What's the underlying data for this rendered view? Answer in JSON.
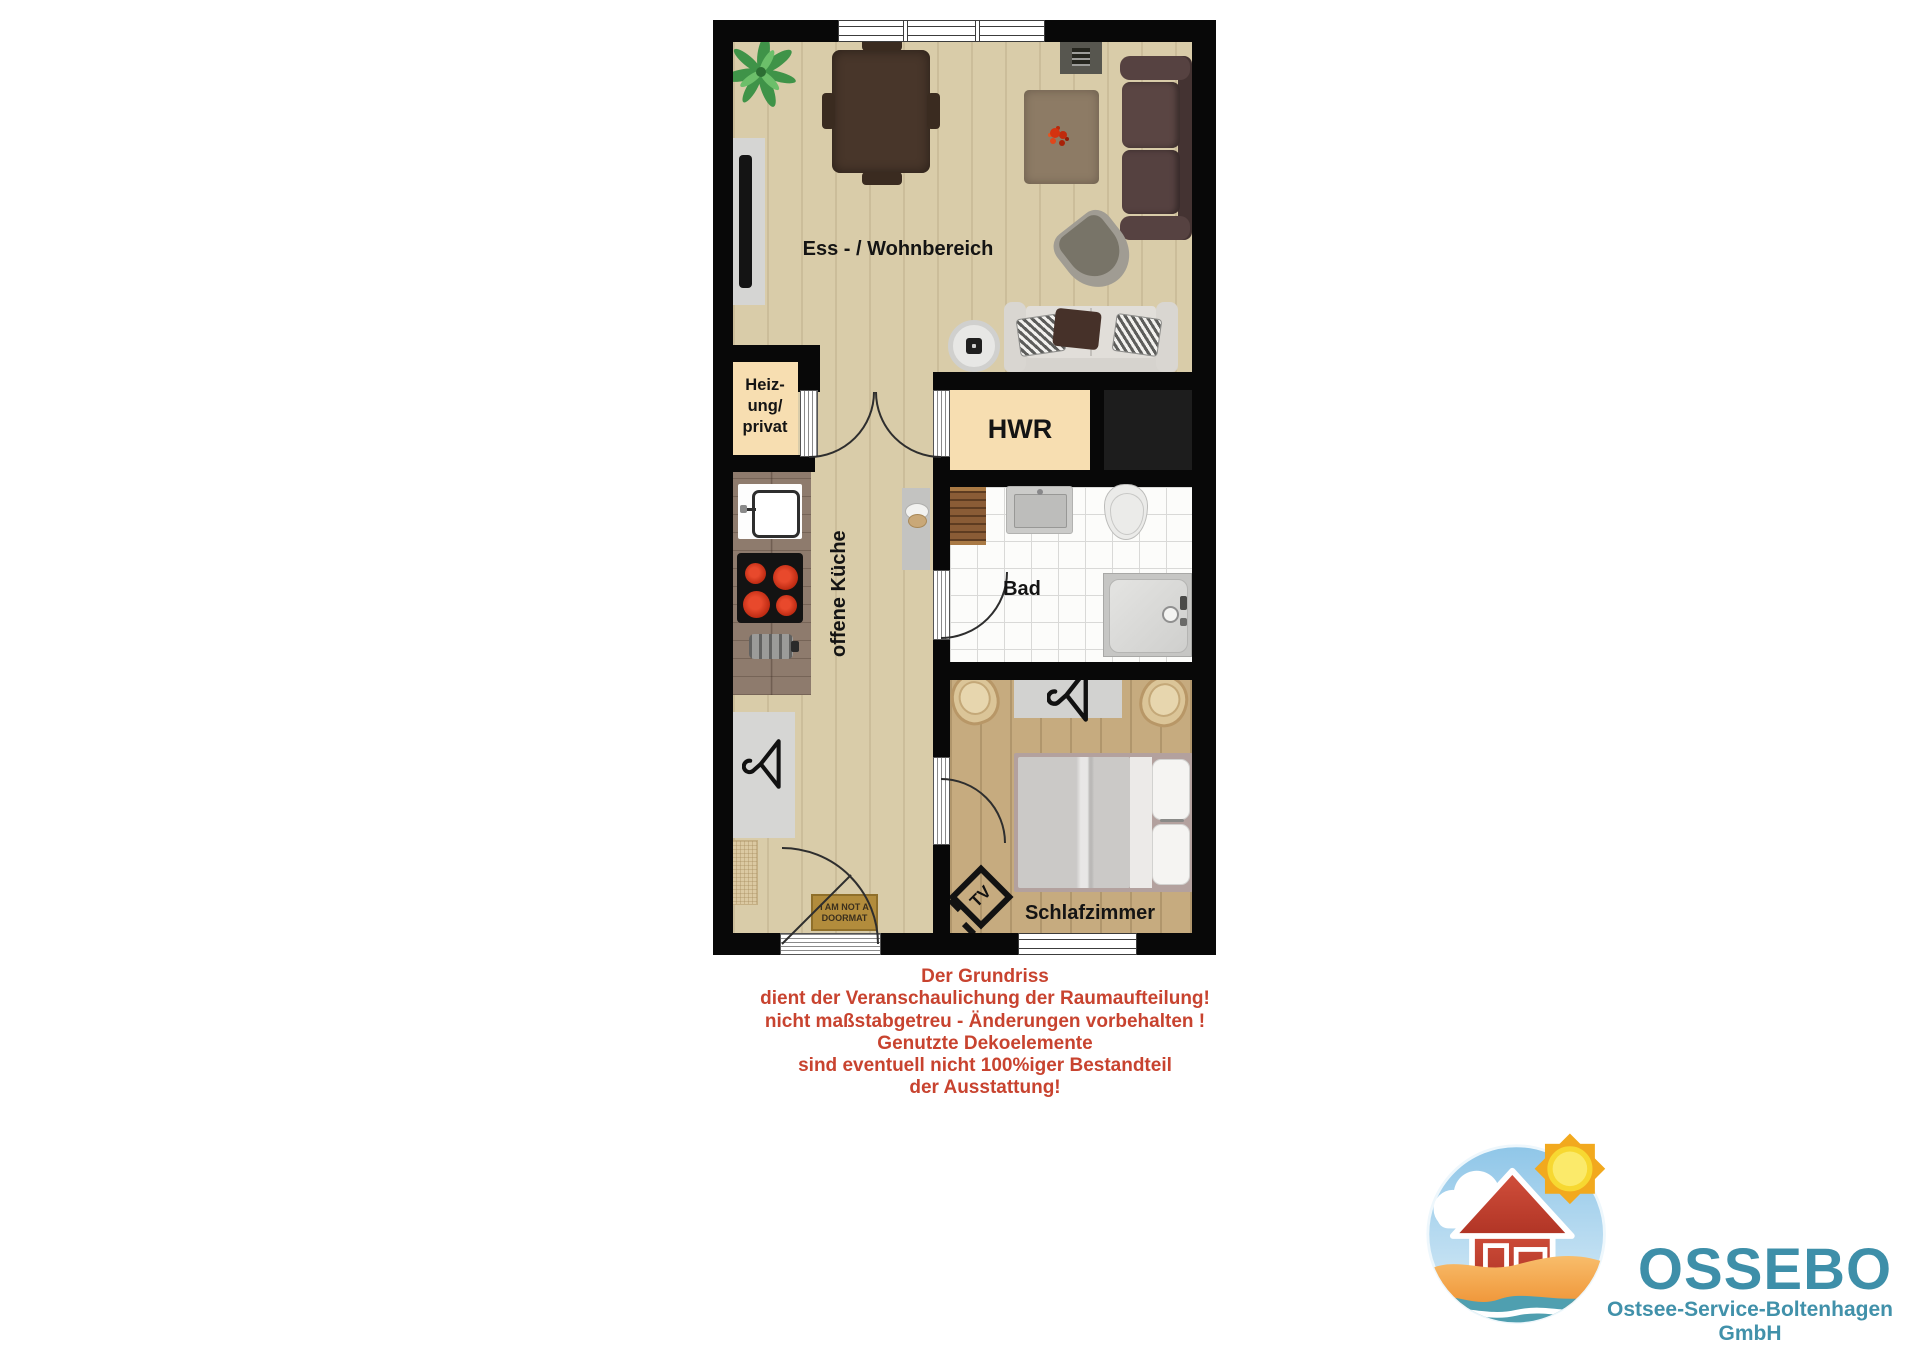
{
  "plan": {
    "rooms": {
      "living": {
        "label": "Ess - / Wohnbereich"
      },
      "heizung": {
        "line1": "Heiz-",
        "line2": "ung/",
        "line3": "privat"
      },
      "hwr": {
        "label": "HWR"
      },
      "kueche": {
        "label": "offene Küche"
      },
      "bad": {
        "label": "Bad"
      },
      "schlafzimmer": {
        "label": "Schlafzimmer"
      }
    },
    "doormat": {
      "line1": "I AM NOT A",
      "line2": "DOORMAT"
    },
    "tv_marker": "TV",
    "colors": {
      "wall": "#080808",
      "floor_light": "#d9cca9",
      "floor_bedroom": "#c6ab7f",
      "room_cream": "#f7deb1",
      "bath_tile": "#fcfcfa"
    }
  },
  "disclaimer": {
    "color": "#c8432f",
    "lines": [
      "Der Grundriss",
      "dient der Veranschaulichung der Raumaufteilung!",
      "nicht maßstabgetreu - Änderungen vorbehalten !",
      "Genutzte Dekoelemente",
      "sind eventuell nicht 100%iger Bestandteil",
      "der Ausstattung!"
    ]
  },
  "logo": {
    "name": "OSSEBO",
    "subtitle": "Ostsee-Service-Boltenhagen GmbH",
    "text_color": "#3e8fa9"
  }
}
